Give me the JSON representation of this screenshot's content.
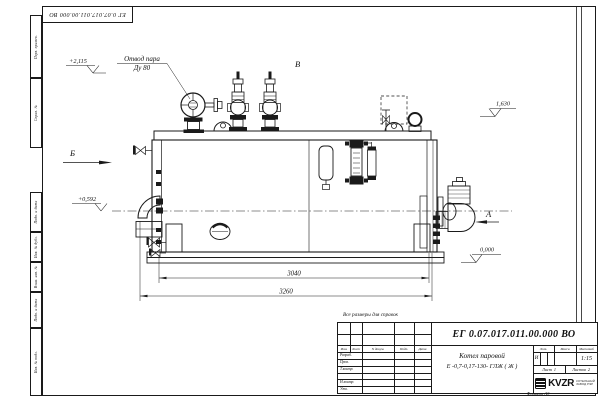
{
  "doc_number": "ЕГ 0.07.017.011.00.000  ВО",
  "frame_columns": [
    "Перв. примен.",
    "Справ. №",
    "Подп. и дата",
    "Инв. № дубл.",
    "Взам. инв. №",
    "Подп. и дата",
    "Инв. № подл."
  ],
  "annotations": {
    "steam_outlet_line1": "Отвод пара",
    "steam_outlet_line2": "Ду 80",
    "elev_valves": "+2,115",
    "elev_axis": "+0,592",
    "elev_right": "1,630",
    "elev_zero": "0,000",
    "view_a": "А",
    "view_b": "Б",
    "view_v": "В",
    "dim_inner": "3040",
    "dim_outer": "3260",
    "note_reference": "Все размеры для справок"
  },
  "title_block": {
    "headers": {
      "izm": "Изм.",
      "list": "Лист",
      "doc": "N докум.",
      "sign": "Подп.",
      "date": "Дата",
      "lit": "Лит.",
      "mass": "Масса",
      "scale": "Масштаб"
    },
    "roles": {
      "developed": "Разраб.",
      "checked": "Пров.",
      "tcontrol": "Т.контр.",
      "ncontrol": "Н.контр.",
      "approved": "Утв."
    },
    "product_name_line1": "Котел паровой",
    "product_name_line2": "Е -0,7-0,17-130- ГЛЖ ( Ж )",
    "lit_value": "И",
    "scale_value": "1:15",
    "sheet_label": "Лист",
    "sheet_value": "1",
    "sheets_label": "Листов",
    "sheets_value": "2",
    "logo_text": "KVZR",
    "logo_sub_line1": "КОТЕЛЬНЫЙ",
    "logo_sub_line2": "ЗАВОД РЭР",
    "format_label": "Формат А3"
  }
}
